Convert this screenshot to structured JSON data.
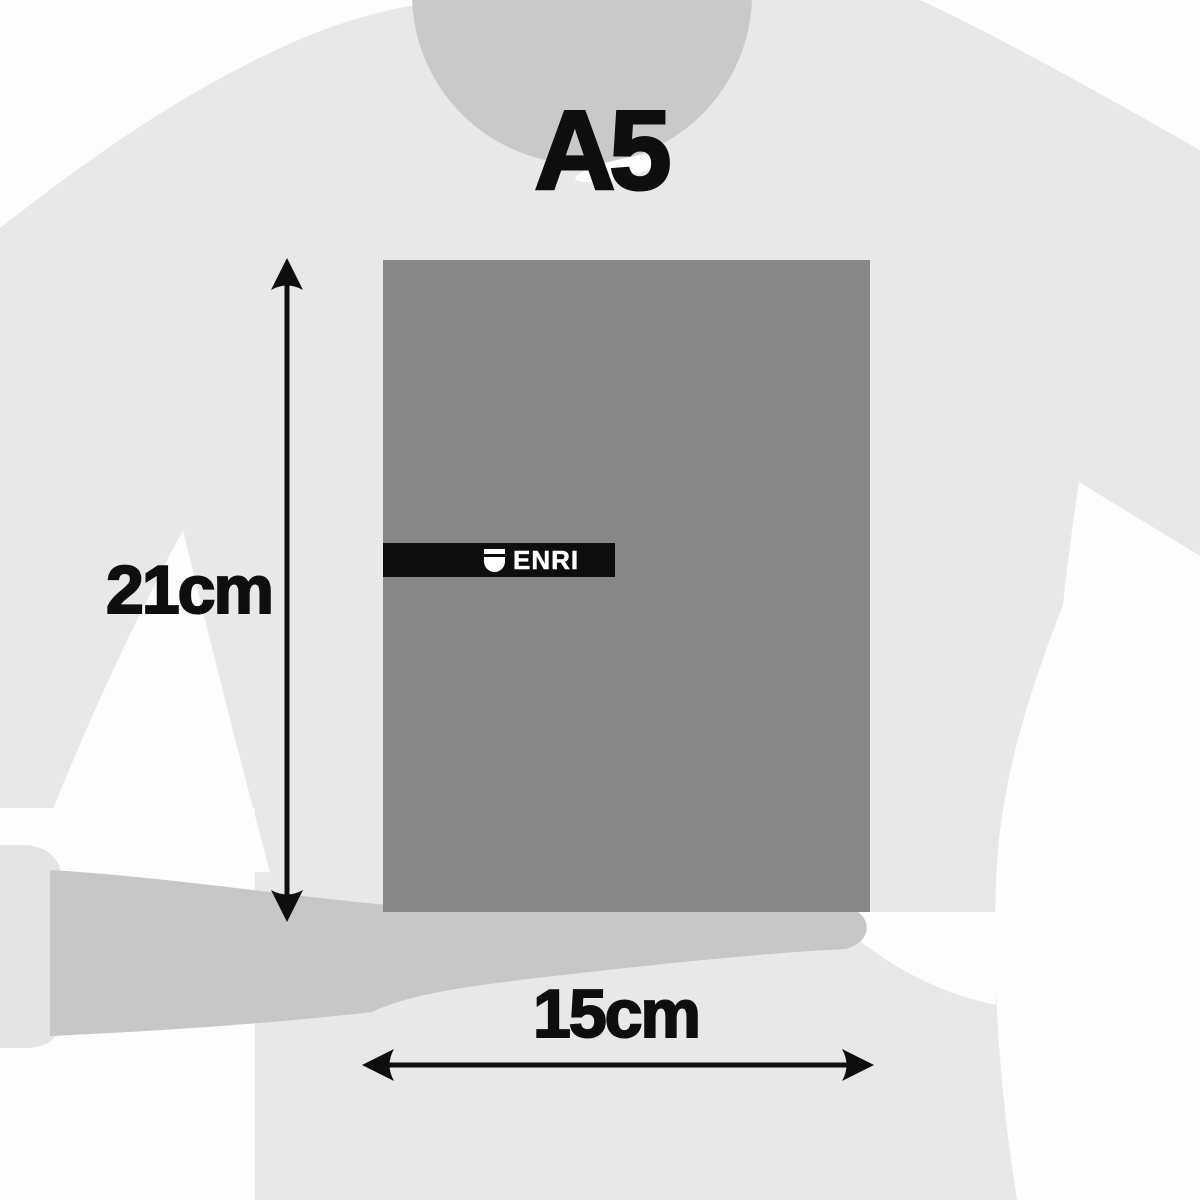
{
  "title": "A5",
  "dimensions": {
    "height": "21cm",
    "width": "15cm"
  },
  "brand": {
    "name": "ENRI"
  },
  "colors": {
    "background": "#fdfdfd",
    "silhouette_body": "#e8e8e9",
    "silhouette_head": "#c9c9ca",
    "silhouette_forearm": "#c7c7c7",
    "silhouette_cuff": "#e4e4e4",
    "notepad_cover": "#878787",
    "logo_band": "#0d0d0d",
    "logo_foreground": "#ffffff",
    "annotation": "#0e0e0e"
  }
}
